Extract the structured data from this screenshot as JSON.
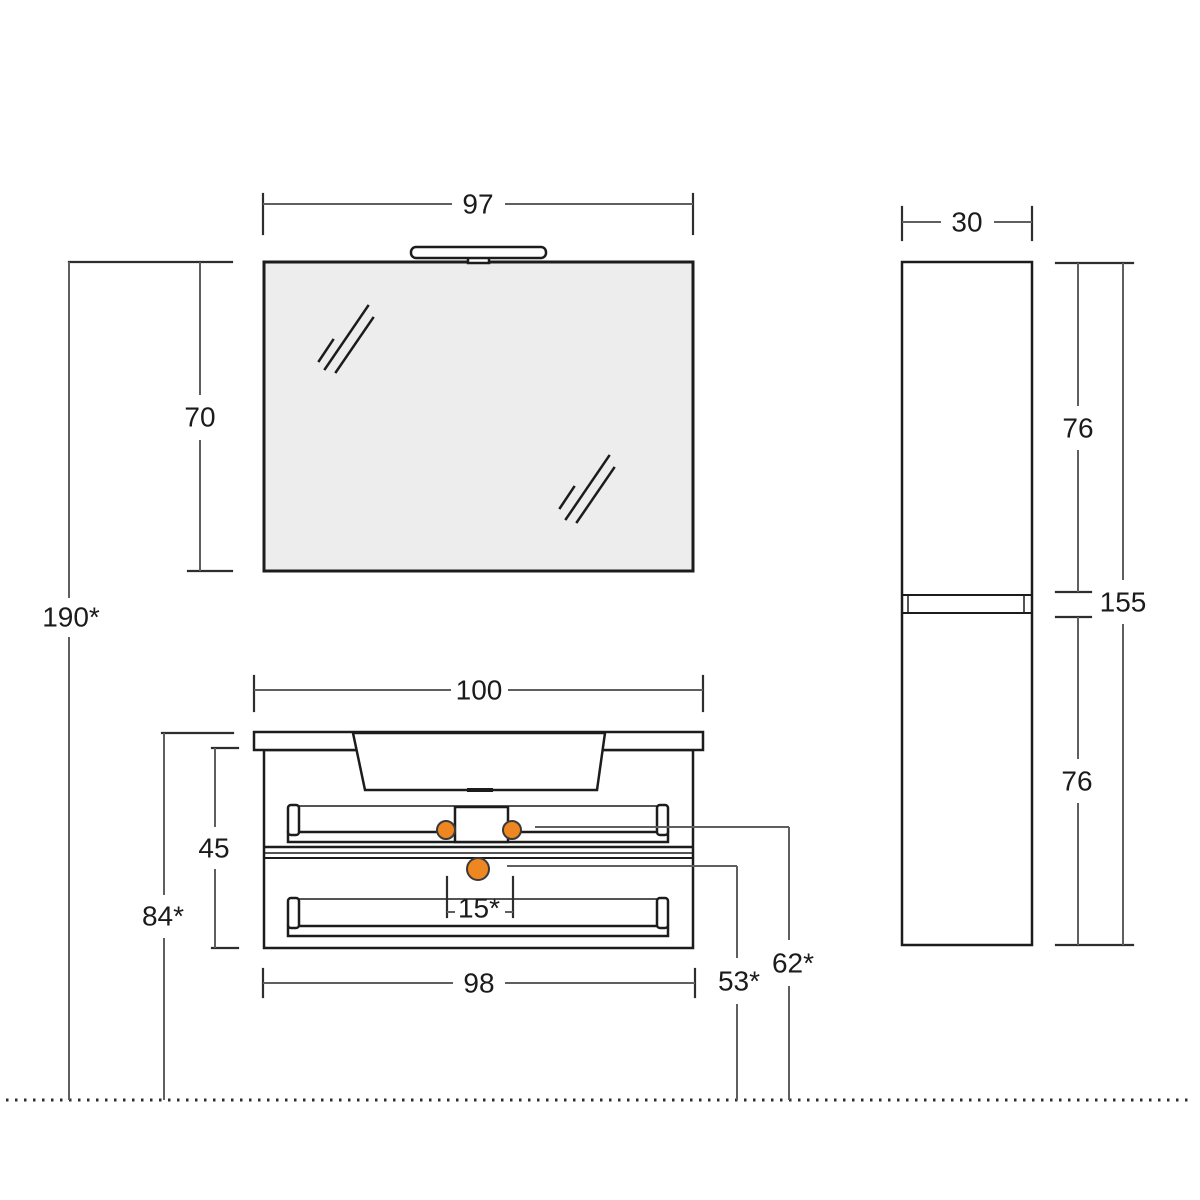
{
  "dimensions": {
    "mirror_width": "97",
    "mirror_height": "70",
    "overall_height": "190*",
    "vanity_top_width": "100",
    "vanity_body_height": "45",
    "worktop_height_from_floor": "84*",
    "knob_spacing": "15*",
    "vanity_bottom_width": "98",
    "drain_height_from_floor": "53*",
    "supply_height_from_floor": "62*",
    "column_width": "30",
    "column_upper_door_height": "76",
    "column_total_height": "155",
    "column_lower_door_height": "76"
  },
  "colors": {
    "outline": "#1c1c1c",
    "dimension_line": "#5f5f5f",
    "tick": "#2e2e2e",
    "text": "#1b1b1b",
    "accent_orange": "#ee8722",
    "accent_border": "#3a3a3a",
    "mirror_fill": "#ededee",
    "background": "#ffffff"
  }
}
